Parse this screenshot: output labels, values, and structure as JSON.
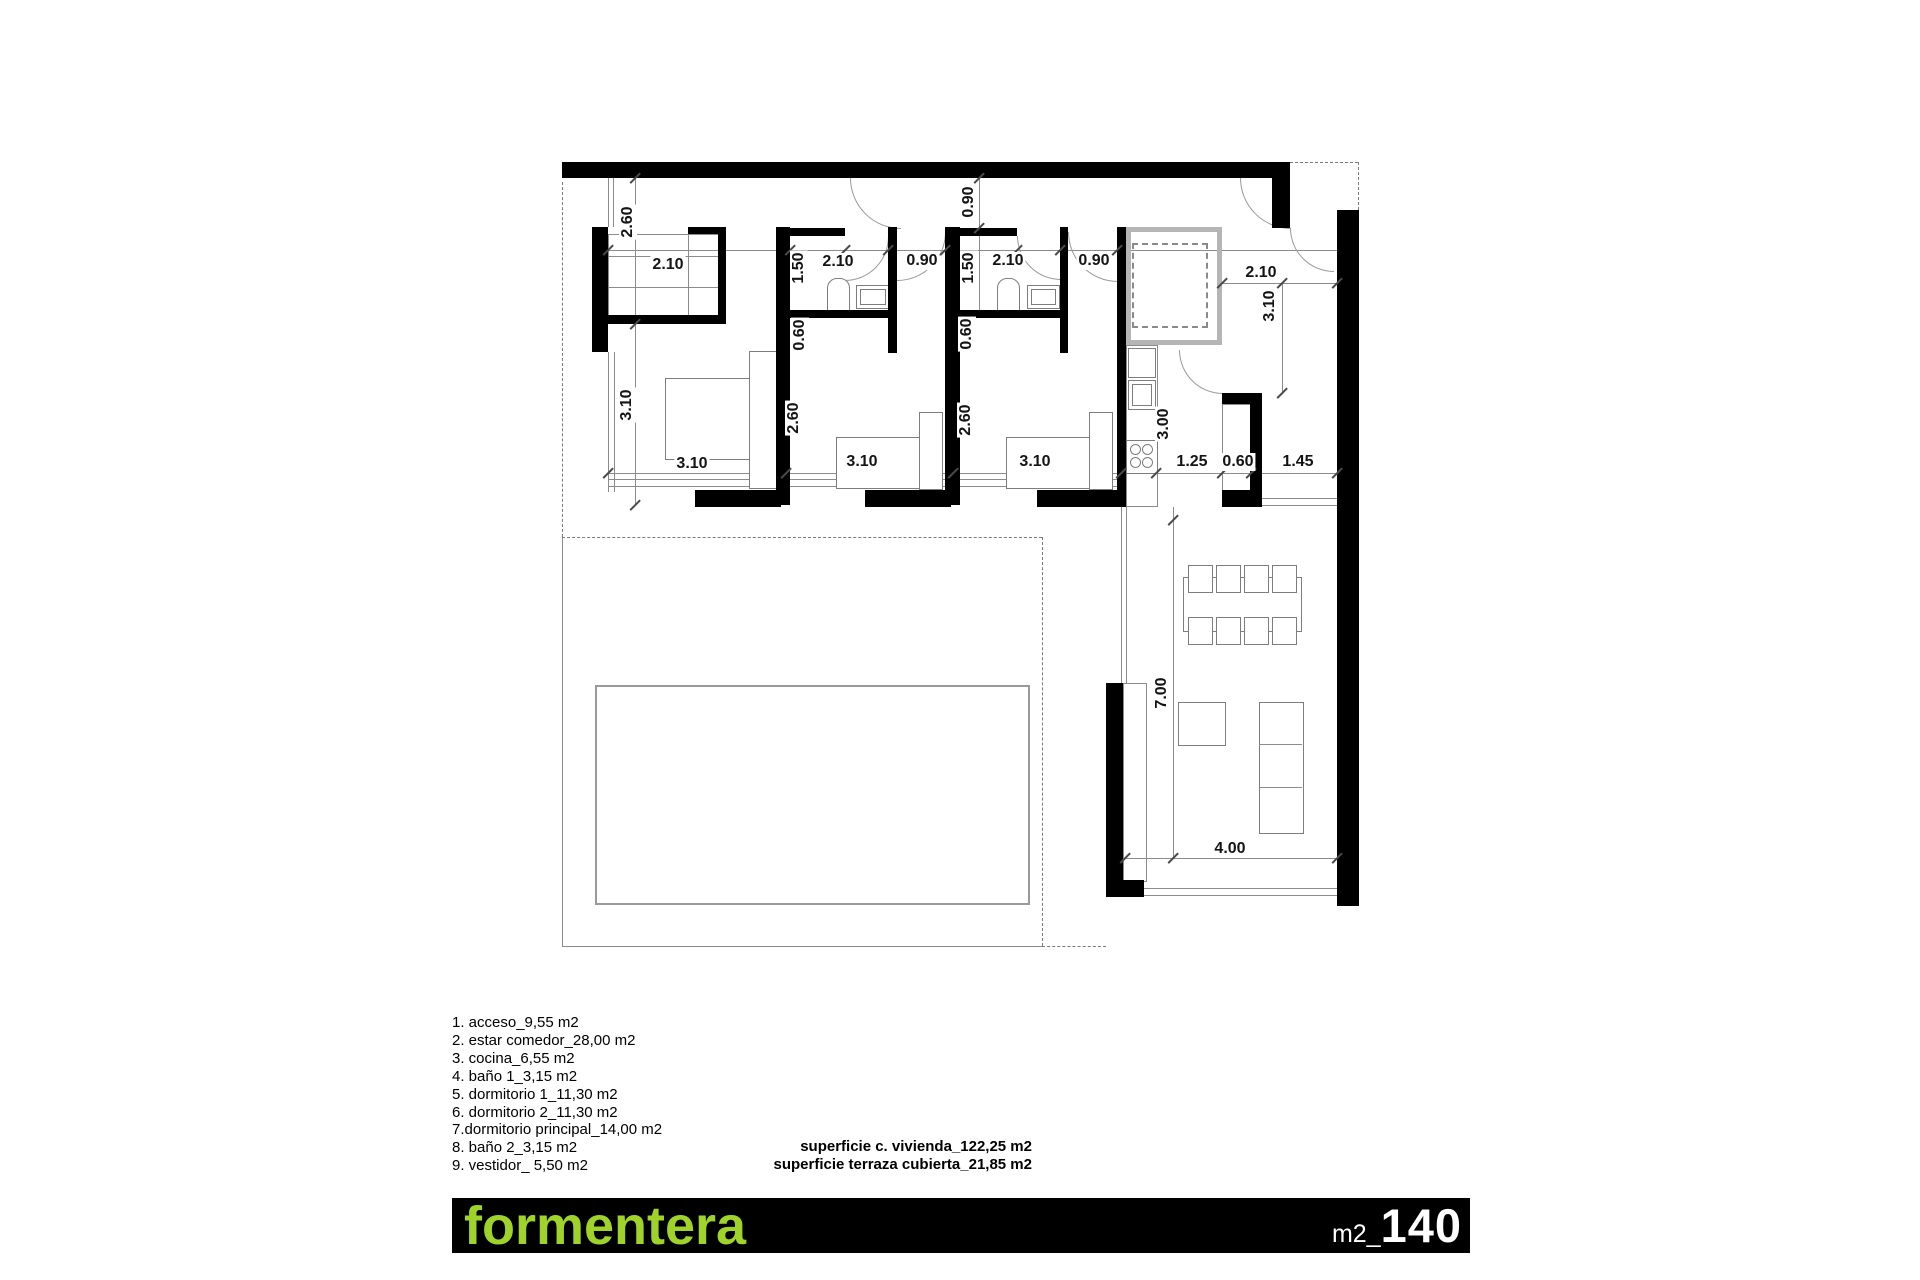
{
  "colors": {
    "accent_green": "#9fd32a",
    "wall_black": "#000000",
    "line_gray": "#8c8c8c"
  },
  "legend": {
    "items": [
      "1. acceso_9,55 m2",
      "2. estar comedor_28,00 m2",
      "3. cocina_6,55 m2",
      "4. baño 1_3,15 m2",
      "5. dormitorio 1_11,30 m2",
      "6. dormitorio 2_11,30 m2",
      "7.dormitorio principal_14,00 m2",
      "8. baño 2_3,15 m2",
      "9. vestidor_ 5,50 m2"
    ]
  },
  "totals": {
    "line1": "superficie c. vivienda_122,25 m2",
    "line2": "superficie terraza cubierta_21,85 m2"
  },
  "titlebar": {
    "name": "formentera",
    "unit_prefix": "m2_",
    "area": "140"
  },
  "dims": {
    "vestidor_h": "2.60",
    "vestidor_w": "2.10",
    "dormp_h": "3.10",
    "bath1_h": "1.50",
    "bath1_w": "2.10",
    "hall1_w": "0.90",
    "entry_door": "0.90",
    "bath2_h": "1.50",
    "bath2_w": "2.10",
    "hall2_w": "0.90",
    "off1": "0.60",
    "off2": "0.60",
    "dorm1_h": "2.60",
    "dorm2_h": "2.60",
    "dormp_w": "3.10",
    "dorm1_w": "3.10",
    "dorm2_w": "3.10",
    "kitchen_h": "3.00",
    "k_seg1": "1.25",
    "k_seg2": "0.60",
    "k_seg3": "1.45",
    "entry_w": "2.10",
    "entry_h": "3.10",
    "living_h": "7.00",
    "living_w": "4.00"
  }
}
